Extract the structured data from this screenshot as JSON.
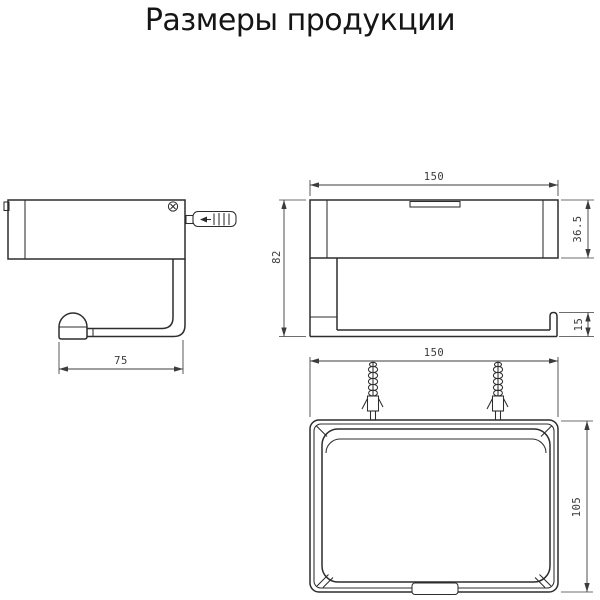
{
  "title": "Размеры продукции",
  "drawing": {
    "side_view": {
      "dim_arm_length": "75"
    },
    "front_view": {
      "dim_width": "150",
      "dim_body_height": "36.5",
      "dim_total_height": "82",
      "dim_hook_lip": "15"
    },
    "top_view": {
      "dim_width": "150",
      "dim_depth": "105"
    }
  },
  "colors": {
    "background": "#ffffff",
    "line": "#2d2d2d",
    "dimension_line": "#3c3c3c",
    "title_text": "#151515"
  }
}
